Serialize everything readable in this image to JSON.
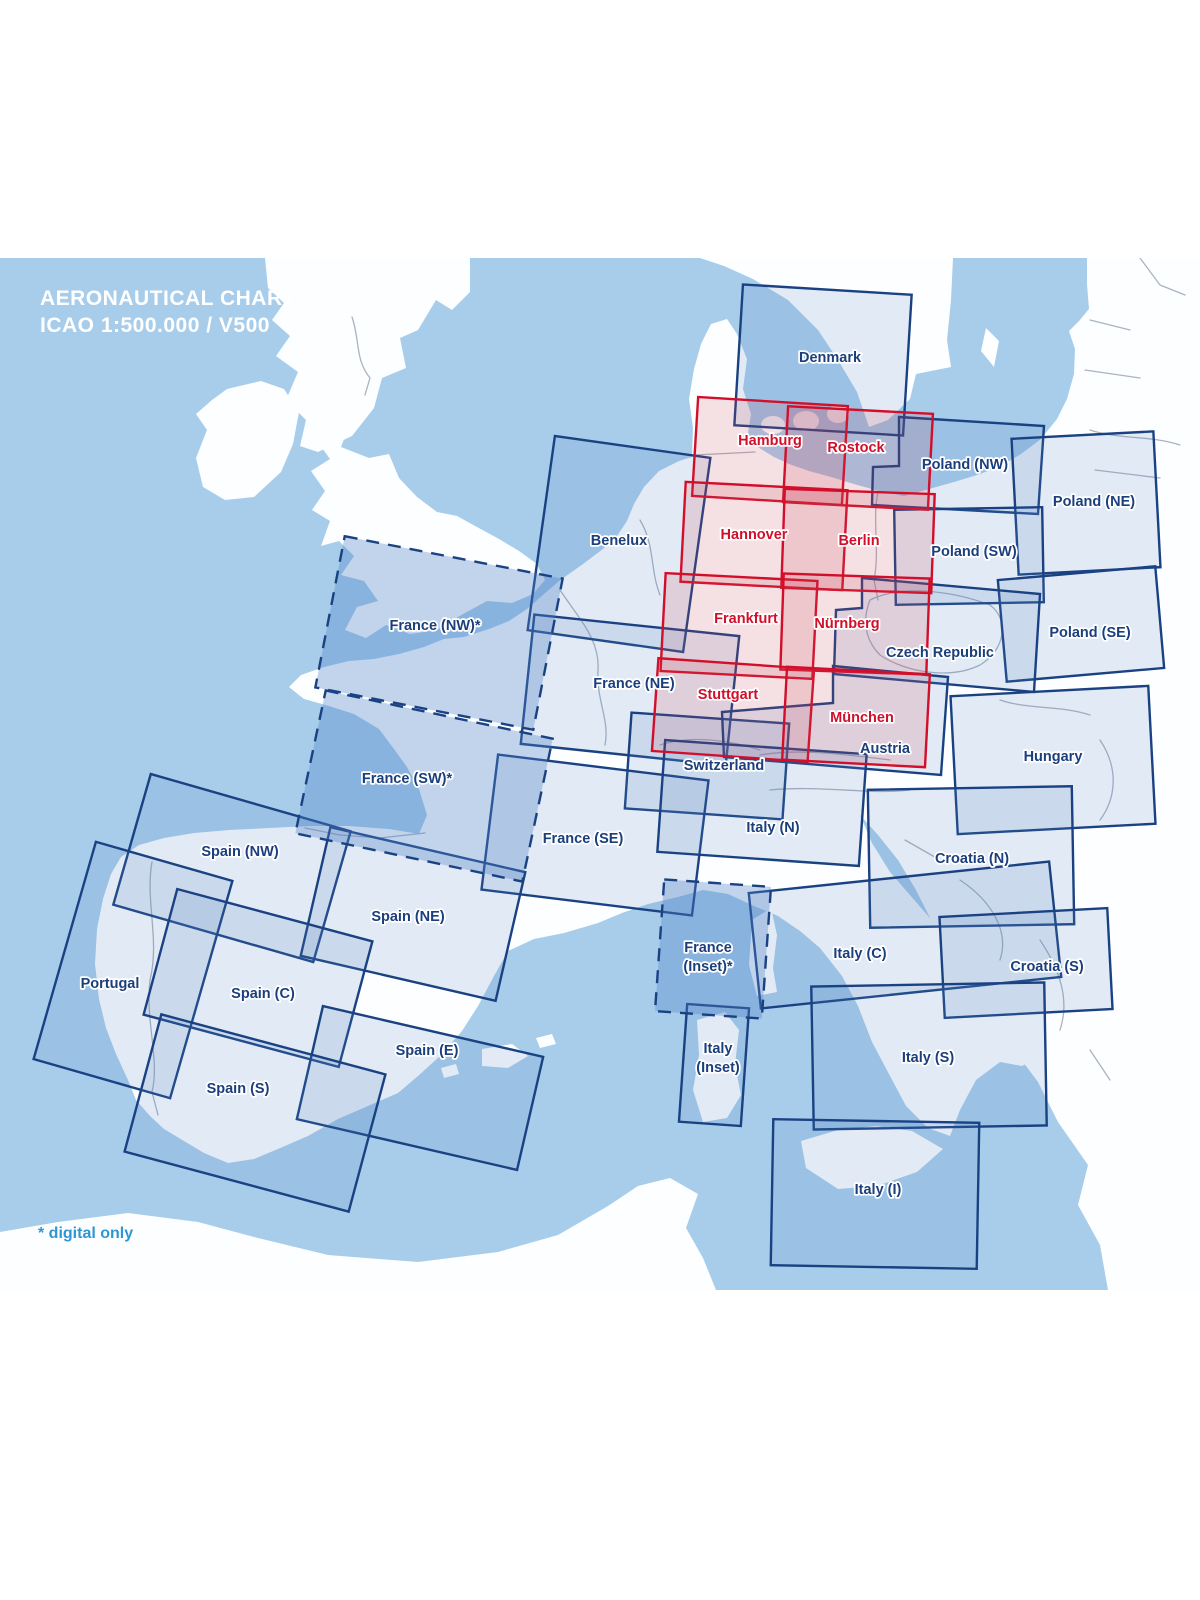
{
  "title": {
    "line1": "AERONAUTICAL CHARTS",
    "line2": "ICAO 1:500.000 / V500"
  },
  "footnote": "* digital only",
  "colors": {
    "sea": "#a8cdeb",
    "land": "#fdfeff",
    "blue": "#1a4282",
    "bluelabel": "#1b3f7c",
    "red": "#d20f2a",
    "note": "#2e96d4"
  },
  "legend": {
    "red_meaning": "German charts",
    "dashed_meaning": "digital only"
  },
  "regions": [
    {
      "id": "denmark",
      "label": "Denmark",
      "type": "std",
      "shape": "rect",
      "cx": 823,
      "cy": 360,
      "w": 169,
      "h": 141,
      "rot": 3.5,
      "lx": 830,
      "ly": 362
    },
    {
      "id": "poland-nw",
      "label": "Poland (NW)",
      "type": "std",
      "shape": "poly",
      "points": [
        [
          899,
          417
        ],
        [
          1044,
          426
        ],
        [
          1038,
          514
        ],
        [
          872,
          505
        ],
        [
          873,
          467
        ],
        [
          899,
          466
        ]
      ],
      "lx": 965,
      "ly": 469
    },
    {
      "id": "poland-ne",
      "label": "Poland (NE)",
      "type": "std",
      "shape": "rect",
      "cx": 1086,
      "cy": 503,
      "w": 142,
      "h": 136,
      "rot": -3,
      "lx": 1094,
      "ly": 506
    },
    {
      "id": "poland-sw",
      "label": "Poland (SW)",
      "type": "std",
      "shape": "rect",
      "cx": 969,
      "cy": 556,
      "w": 148,
      "h": 95,
      "rot": -1,
      "lx": 974,
      "ly": 556
    },
    {
      "id": "poland-se",
      "label": "Poland (SE)",
      "type": "std",
      "shape": "rect",
      "cx": 1081,
      "cy": 624,
      "w": 158,
      "h": 102,
      "rot": -5,
      "lx": 1090,
      "ly": 637
    },
    {
      "id": "czech-republic",
      "label": "Czech Republic",
      "type": "std",
      "shape": "poly",
      "points": [
        [
          862,
          578
        ],
        [
          1040,
          594
        ],
        [
          1034,
          692
        ],
        [
          834,
          674
        ],
        [
          836,
          610
        ],
        [
          862,
          608
        ]
      ],
      "lx": 940,
      "ly": 657
    },
    {
      "id": "benelux",
      "label": "Benelux",
      "type": "std",
      "shape": "rect",
      "cx": 619,
      "cy": 544,
      "w": 157,
      "h": 196,
      "rot": 8,
      "lx": 619,
      "ly": 545
    },
    {
      "id": "france-ne",
      "label": "France (NE)",
      "type": "std",
      "shape": "rect",
      "cx": 630,
      "cy": 690,
      "w": 206,
      "h": 130,
      "rot": 6,
      "lx": 634,
      "ly": 688
    },
    {
      "id": "switzerland",
      "label": "Switzerland",
      "type": "std",
      "shape": "rect",
      "cx": 707,
      "cy": 766,
      "w": 158,
      "h": 96,
      "rot": 4,
      "lx": 724,
      "ly": 770
    },
    {
      "id": "austria",
      "label": "Austria",
      "type": "std",
      "shape": "poly",
      "points": [
        [
          833,
          666
        ],
        [
          948,
          677
        ],
        [
          941,
          775
        ],
        [
          724,
          757
        ],
        [
          722,
          712
        ],
        [
          833,
          703
        ]
      ],
      "lx": 885,
      "ly": 753
    },
    {
      "id": "hungary",
      "label": "Hungary",
      "type": "std",
      "shape": "rect",
      "cx": 1053,
      "cy": 760,
      "w": 198,
      "h": 138,
      "rot": -3,
      "lx": 1053,
      "ly": 761
    },
    {
      "id": "france-se",
      "label": "France (SE)",
      "type": "std",
      "shape": "rect",
      "cx": 595,
      "cy": 835,
      "w": 212,
      "h": 136,
      "rot": 7,
      "lx": 583,
      "ly": 843
    },
    {
      "id": "italy-n",
      "label": "Italy (N)",
      "type": "std",
      "shape": "rect",
      "cx": 762,
      "cy": 803,
      "w": 202,
      "h": 112,
      "rot": 4,
      "lx": 773,
      "ly": 832
    },
    {
      "id": "croatia-n",
      "label": "Croatia (N)",
      "type": "std",
      "shape": "rect",
      "cx": 971,
      "cy": 857,
      "w": 204,
      "h": 138,
      "rot": -1,
      "lx": 972,
      "ly": 863
    },
    {
      "id": "spain-nw",
      "label": "Spain (NW)",
      "type": "std",
      "shape": "rect",
      "cx": 232,
      "cy": 868,
      "w": 208,
      "h": 136,
      "rot": 16,
      "lx": 240,
      "ly": 856
    },
    {
      "id": "spain-ne",
      "label": "Spain (NE)",
      "type": "std",
      "shape": "rect",
      "cx": 413,
      "cy": 914,
      "w": 200,
      "h": 132,
      "rot": 13,
      "lx": 408,
      "ly": 921
    },
    {
      "id": "portugal",
      "label": "Portugal",
      "type": "std",
      "shape": "rect",
      "cx": 133,
      "cy": 970,
      "w": 142,
      "h": 226,
      "rot": 16,
      "lx": 110,
      "ly": 988
    },
    {
      "id": "spain-c",
      "label": "Spain (C)",
      "type": "std",
      "shape": "rect",
      "cx": 258,
      "cy": 978,
      "w": 202,
      "h": 130,
      "rot": 15,
      "lx": 263,
      "ly": 998
    },
    {
      "id": "italy-c",
      "label": "Italy (C)",
      "type": "std",
      "shape": "rect",
      "cx": 905,
      "cy": 935,
      "w": 302,
      "h": 116,
      "rot": -6,
      "lx": 860,
      "ly": 958
    },
    {
      "id": "croatia-s",
      "label": "Croatia (S)",
      "type": "std",
      "shape": "rect",
      "cx": 1026,
      "cy": 963,
      "w": 168,
      "h": 101,
      "rot": -3,
      "lx": 1047,
      "ly": 971
    },
    {
      "id": "spain-e",
      "label": "Spain (E)",
      "type": "std",
      "shape": "rect",
      "cx": 420,
      "cy": 1088,
      "w": 226,
      "h": 116,
      "rot": 13,
      "lx": 427,
      "ly": 1055
    },
    {
      "id": "italy-inset",
      "label": "Italy",
      "label2": "(Inset)",
      "type": "std",
      "shape": "rect",
      "cx": 714,
      "cy": 1065,
      "w": 62,
      "h": 118,
      "rot": 4,
      "lx": 718,
      "ly": 1053
    },
    {
      "id": "italy-s",
      "label": "Italy (S)",
      "type": "std",
      "shape": "rect",
      "cx": 929,
      "cy": 1056,
      "w": 233,
      "h": 143,
      "rot": -1,
      "lx": 928,
      "ly": 1062
    },
    {
      "id": "spain-s",
      "label": "Spain (S)",
      "type": "std",
      "shape": "rect",
      "cx": 255,
      "cy": 1113,
      "w": 232,
      "h": 142,
      "rot": 15,
      "lx": 238,
      "ly": 1093
    },
    {
      "id": "italy-i",
      "label": "Italy (I)",
      "type": "std",
      "shape": "rect",
      "cx": 875,
      "cy": 1194,
      "w": 206,
      "h": 146,
      "rot": 1,
      "lx": 878,
      "ly": 1194
    },
    {
      "id": "france-nw",
      "label": "France (NW)*",
      "type": "digital",
      "shape": "rect",
      "cx": 439,
      "cy": 633,
      "w": 222,
      "h": 154,
      "rot": 11,
      "lx": 435,
      "ly": 630
    },
    {
      "id": "france-sw",
      "label": "France (SW)*",
      "type": "digital",
      "shape": "rect",
      "cx": 424,
      "cy": 786,
      "w": 232,
      "h": 146,
      "rot": 12,
      "lx": 407,
      "ly": 783
    },
    {
      "id": "france-inset",
      "label": "France",
      "label2": "(Inset)*",
      "type": "digital",
      "shape": "rect",
      "cx": 713,
      "cy": 949,
      "w": 107,
      "h": 132,
      "rot": 4,
      "lx": 708,
      "ly": 952
    },
    {
      "id": "hamburg",
      "label": "Hamburg",
      "type": "de",
      "shape": "rect",
      "cx": 770,
      "cy": 451,
      "w": 150,
      "h": 99,
      "rot": 3.5,
      "lx": 770,
      "ly": 445
    },
    {
      "id": "rostock",
      "label": "Rostock",
      "type": "de",
      "shape": "rect",
      "cx": 858,
      "cy": 458,
      "w": 145,
      "h": 96,
      "rot": 3,
      "lx": 856,
      "ly": 452
    },
    {
      "id": "hannover",
      "label": "Hannover",
      "type": "de",
      "shape": "rect",
      "cx": 764,
      "cy": 536,
      "w": 162,
      "h": 100,
      "rot": 3,
      "lx": 754,
      "ly": 539
    },
    {
      "id": "berlin",
      "label": "Berlin",
      "type": "de",
      "shape": "rect",
      "cx": 858,
      "cy": 541,
      "w": 150,
      "h": 99,
      "rot": 2,
      "lx": 859,
      "ly": 545
    },
    {
      "id": "frankfurt",
      "label": "Frankfurt",
      "type": "de",
      "shape": "rect",
      "cx": 739,
      "cy": 626,
      "w": 152,
      "h": 98,
      "rot": 3,
      "lx": 746,
      "ly": 623
    },
    {
      "id": "nurnberg",
      "label": "Nürnberg",
      "type": "de",
      "shape": "rect",
      "cx": 855,
      "cy": 624,
      "w": 146,
      "h": 96,
      "rot": 2,
      "lx": 847,
      "ly": 628
    },
    {
      "id": "stuttgart",
      "label": "Stuttgart",
      "type": "de",
      "shape": "rect",
      "cx": 733,
      "cy": 710,
      "w": 156,
      "h": 93,
      "rot": 4,
      "lx": 728,
      "ly": 699
    },
    {
      "id": "munchen",
      "label": "München",
      "type": "de",
      "shape": "rect",
      "cx": 856,
      "cy": 717,
      "w": 143,
      "h": 93,
      "rot": 3,
      "lx": 862,
      "ly": 722
    }
  ]
}
